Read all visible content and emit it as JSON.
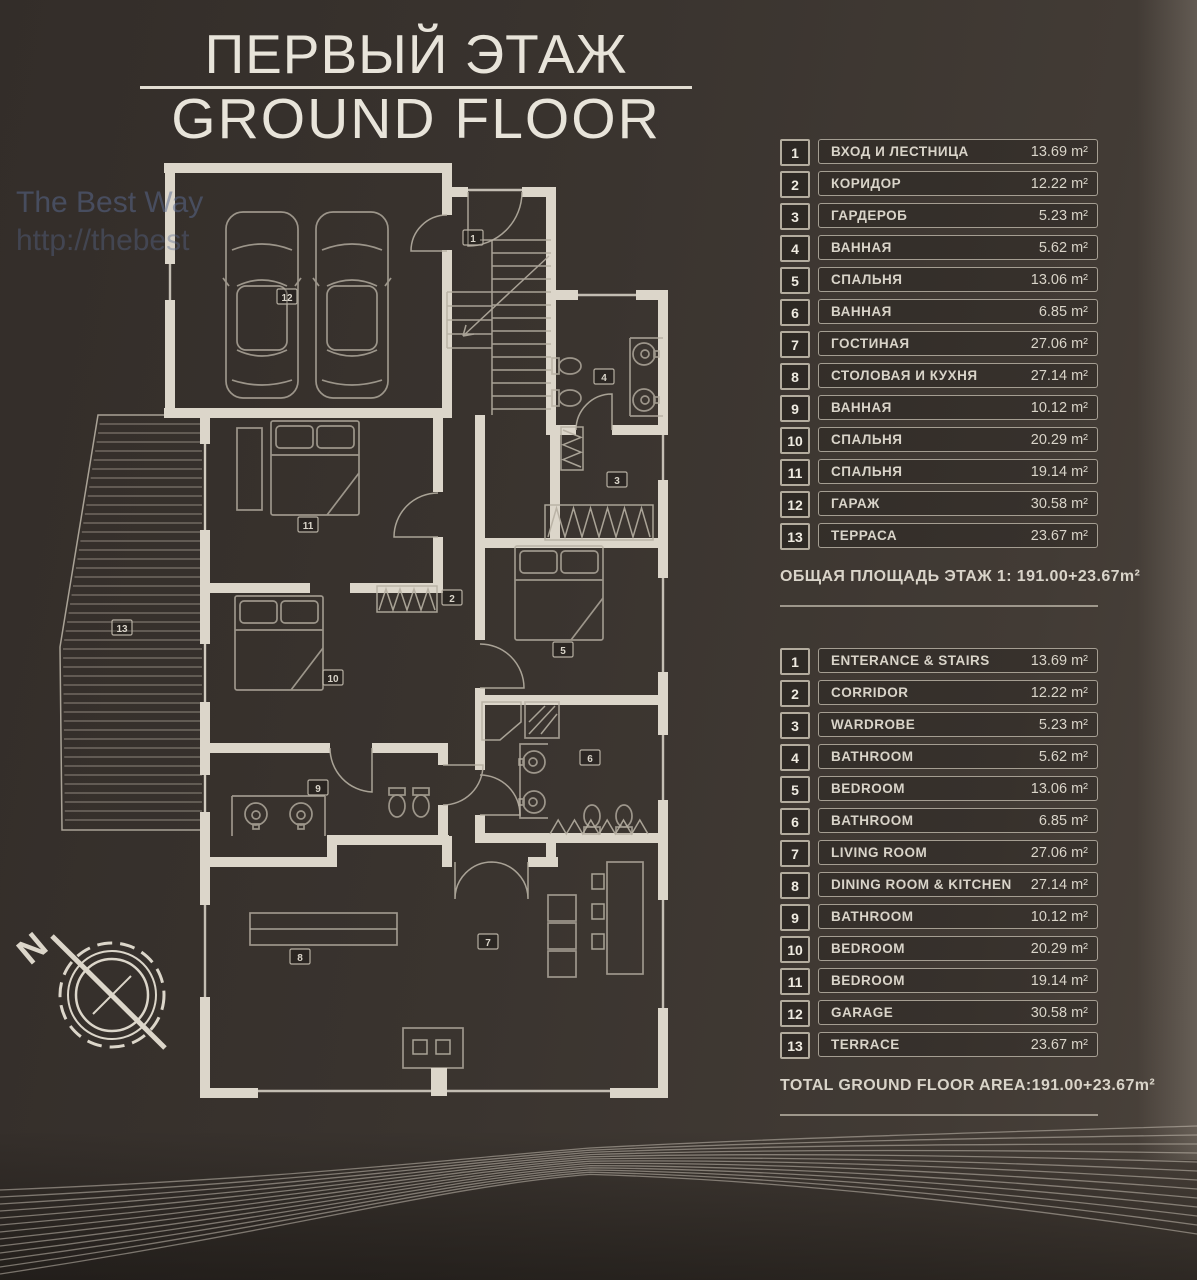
{
  "title": {
    "line1": "ПЕРВЫЙ ЭТАЖ",
    "line2": "GROUND FLOOR"
  },
  "watermark": {
    "line1": "The Best Way",
    "line2": "http://thebest"
  },
  "compass": {
    "north_label": "N"
  },
  "legend_ru": {
    "rows": [
      {
        "num": "1",
        "name": "ВХОД И ЛЕСТНИЦА",
        "area": "13.69 m²"
      },
      {
        "num": "2",
        "name": "КОРИДОР",
        "area": "12.22 m²"
      },
      {
        "num": "3",
        "name": "ГАРДЕРОБ",
        "area": "5.23 m²"
      },
      {
        "num": "4",
        "name": "ВАННАЯ",
        "area": "5.62 m²"
      },
      {
        "num": "5",
        "name": "СПАЛЬНЯ",
        "area": "13.06 m²"
      },
      {
        "num": "6",
        "name": "ВАННАЯ",
        "area": "6.85 m²"
      },
      {
        "num": "7",
        "name": "ГОСТИНАЯ",
        "area": "27.06 m²"
      },
      {
        "num": "8",
        "name": "СТОЛОВАЯ И КУХНЯ",
        "area": "27.14 m²"
      },
      {
        "num": "9",
        "name": "ВАННАЯ",
        "area": "10.12 m²"
      },
      {
        "num": "10",
        "name": "СПАЛЬНЯ",
        "area": "20.29 m²"
      },
      {
        "num": "11",
        "name": "СПАЛЬНЯ",
        "area": "19.14 m²"
      },
      {
        "num": "12",
        "name": "ГАРАЖ",
        "area": "30.58 m²"
      },
      {
        "num": "13",
        "name": "ТЕРРАСА",
        "area": "23.67 m²"
      }
    ],
    "total": "ОБЩАЯ ПЛОЩАДЬ  ЭТАЖ 1: 191.00+23.67m²"
  },
  "legend_en": {
    "rows": [
      {
        "num": "1",
        "name": "ENTERANCE & STAIRS",
        "area": "13.69 m²"
      },
      {
        "num": "2",
        "name": "CORRIDOR",
        "area": "12.22 m²"
      },
      {
        "num": "3",
        "name": "WARDROBE",
        "area": "5.23 m²"
      },
      {
        "num": "4",
        "name": "BATHROOM",
        "area": "5.62 m²"
      },
      {
        "num": "5",
        "name": "BEDROOM",
        "area": "13.06 m²"
      },
      {
        "num": "6",
        "name": "BATHROOM",
        "area": "6.85 m²"
      },
      {
        "num": "7",
        "name": "LIVING ROOM",
        "area": "27.06 m²"
      },
      {
        "num": "8",
        "name": "DINING ROOM & KITCHEN",
        "area": "27.14 m²"
      },
      {
        "num": "9",
        "name": "BATHROOM",
        "area": "10.12 m²"
      },
      {
        "num": "10",
        "name": "BEDROOM",
        "area": "20.29 m²"
      },
      {
        "num": "11",
        "name": "BEDROOM",
        "area": "19.14 m²"
      },
      {
        "num": "12",
        "name": "GARAGE",
        "area": "30.58 m²"
      },
      {
        "num": "13",
        "name": "TERRACE",
        "area": "23.67 m²"
      }
    ],
    "total": "TOTAL GROUND FLOOR AREA:191.00+23.67m²"
  },
  "plan": {
    "labels": [
      "1",
      "2",
      "3",
      "4",
      "5",
      "6",
      "7",
      "8",
      "9",
      "10",
      "11",
      "12",
      "13"
    ]
  },
  "theme": {
    "background": "#3a342f",
    "plan_line": "#dcd6ca",
    "plan_line_secondary": "#b6afa2",
    "text": "#d9d4c9",
    "watermark_blue": "#5b6c94"
  }
}
